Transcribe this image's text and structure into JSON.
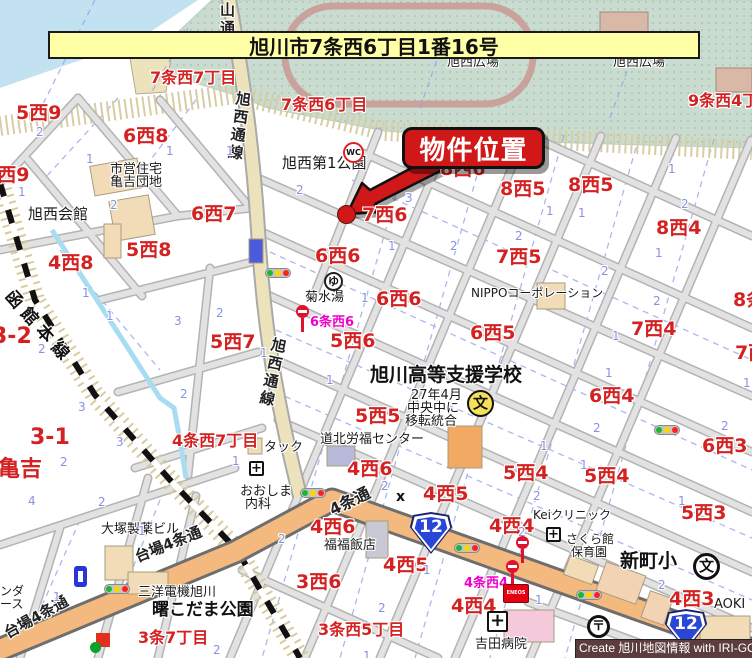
{
  "title_banner": {
    "text": "旭川市7条西6丁目1番16号"
  },
  "callout": {
    "label": "物件位置"
  },
  "credit": {
    "text": "Create 旭川地図情報 with IRI-GO"
  },
  "colors": {
    "banner_bg": "#ffffa6",
    "callout_bg": "#d01818",
    "park": "#cadcd0",
    "water": "#c2e2f2",
    "main_road": "#f4b97e",
    "sub_road": "#ece3bd",
    "block_label_red": "#d42222",
    "lot_number_blue": "#8892e0",
    "bus_label_magenta": "#f000c8",
    "route_shield_blue": "#2a46d4",
    "credit_bg": "#5c3d3d"
  },
  "map_labels": [
    {
      "n": "road-label-yamadori",
      "t": "山通",
      "x": 219,
      "y": 2,
      "c": "road vert"
    },
    {
      "n": "road-label-kyokusei-dori-upper",
      "t": "旭西通線",
      "x": 236,
      "y": 90,
      "c": "road vert",
      "r": 8
    },
    {
      "n": "road-label-kyokusei-dori-lower",
      "t": "旭西通線",
      "x": 272,
      "y": 336,
      "c": "road vert",
      "r": 12
    },
    {
      "n": "railway-label-hakodate-line",
      "t": "函館本線",
      "x": 14,
      "y": 288,
      "c": "rwy",
      "r": 48
    },
    {
      "n": "road-label-daiba-4jo-1",
      "t": "台場4条通",
      "x": 133,
      "y": 551,
      "c": "road-h",
      "r": -22
    },
    {
      "n": "road-label-daiba-4jo-2",
      "t": "台場4条通",
      "x": 2,
      "y": 628,
      "c": "road-h",
      "r": -29
    },
    {
      "n": "road-label-4jo-dori",
      "t": "4条通",
      "x": 327,
      "y": 504,
      "c": "road-h lg",
      "r": -26
    },
    {
      "n": "park-label-hiroba-1",
      "t": "旭西広場",
      "x": 447,
      "y": 56,
      "c": "poi"
    },
    {
      "n": "park-label-hiroba-2",
      "t": "旭西広場",
      "x": 613,
      "y": 56,
      "c": "poi"
    },
    {
      "n": "block-label",
      "t": "7条西7丁目",
      "x": 150,
      "y": 70,
      "c": "blk-md"
    },
    {
      "n": "block-label",
      "t": "7条西6丁目",
      "x": 281,
      "y": 97,
      "c": "blk-md"
    },
    {
      "n": "block-label",
      "t": "9条西4丁目",
      "x": 688,
      "y": 93,
      "c": "blk-md"
    },
    {
      "n": "block-label",
      "t": "5西9",
      "x": 16,
      "y": 104,
      "c": "blk"
    },
    {
      "n": "block-label",
      "t": "5西9",
      "x": -16,
      "y": 166,
      "c": "blk"
    },
    {
      "n": "block-label",
      "t": "6西8",
      "x": 123,
      "y": 127,
      "c": "blk"
    },
    {
      "n": "block-label",
      "t": "6西7",
      "x": 191,
      "y": 205,
      "c": "blk"
    },
    {
      "n": "block-label",
      "t": "5西8",
      "x": 126,
      "y": 241,
      "c": "blk"
    },
    {
      "n": "block-label",
      "t": "4西8",
      "x": 48,
      "y": 254,
      "c": "blk"
    },
    {
      "n": "poi-label-shiei-jutaku",
      "t": "市営住宅",
      "x": 110,
      "y": 163,
      "c": "poi"
    },
    {
      "n": "poi-label-kamekichi-danchi",
      "t": "亀吉団地",
      "x": 110,
      "y": 176,
      "c": "poi"
    },
    {
      "n": "poi-label-kyokusei-kaikan",
      "t": "旭西会館",
      "x": 28,
      "y": 207,
      "c": "poi-md"
    },
    {
      "n": "poi-label-kyokusei-park",
      "t": "旭西第1公園",
      "x": 282,
      "y": 156,
      "c": "poi-md"
    },
    {
      "n": "block-label",
      "t": "8西6",
      "x": 440,
      "y": 160,
      "c": "blk"
    },
    {
      "n": "block-label",
      "t": "8西5",
      "x": 500,
      "y": 180,
      "c": "blk"
    },
    {
      "n": "block-label",
      "t": "8西5",
      "x": 568,
      "y": 176,
      "c": "blk"
    },
    {
      "n": "block-label",
      "t": "8西4",
      "x": 656,
      "y": 219,
      "c": "blk"
    },
    {
      "n": "block-label",
      "t": "7西6",
      "x": 362,
      "y": 206,
      "c": "blk"
    },
    {
      "n": "block-label",
      "t": "7西5",
      "x": 496,
      "y": 248,
      "c": "blk"
    },
    {
      "n": "block-label",
      "t": "7西4",
      "x": 631,
      "y": 320,
      "c": "blk"
    },
    {
      "n": "block-label",
      "t": "8条西",
      "x": 733,
      "y": 291,
      "c": "blk"
    },
    {
      "n": "block-label",
      "t": "7西3",
      "x": 735,
      "y": 344,
      "c": "blk"
    },
    {
      "n": "block-label",
      "t": "6西6",
      "x": 315,
      "y": 247,
      "c": "blk"
    },
    {
      "n": "block-label",
      "t": "6西6",
      "x": 376,
      "y": 290,
      "c": "blk"
    },
    {
      "n": "block-label",
      "t": "6西5",
      "x": 470,
      "y": 324,
      "c": "blk"
    },
    {
      "n": "block-label",
      "t": "6西4",
      "x": 589,
      "y": 387,
      "c": "blk"
    },
    {
      "n": "block-label",
      "t": "6西3",
      "x": 702,
      "y": 437,
      "c": "blk"
    },
    {
      "n": "poi-label-kikusui-yu",
      "t": "菊水湯",
      "x": 305,
      "y": 291,
      "c": "poi"
    },
    {
      "n": "poi-label-nippo",
      "t": "NIPPOコーポレーション",
      "x": 471,
      "y": 287,
      "c": "poi-sm"
    },
    {
      "n": "block-label",
      "t": "5西6",
      "x": 330,
      "y": 332,
      "c": "blk"
    },
    {
      "n": "block-label",
      "t": "5西7",
      "x": 210,
      "y": 333,
      "c": "blk"
    },
    {
      "n": "block-label",
      "t": "3-2",
      "x": -8,
      "y": 326,
      "c": "blk-lg"
    },
    {
      "n": "block-label",
      "t": "3-1",
      "x": 30,
      "y": 427,
      "c": "blk-lg"
    },
    {
      "n": "poi-label-shien-school",
      "t": "旭川高等支援学校",
      "x": 370,
      "y": 366,
      "c": "poi-lg"
    },
    {
      "n": "poi-label-school-note-1",
      "t": "27年4月",
      "x": 411,
      "y": 389,
      "c": "poi"
    },
    {
      "n": "poi-label-school-note-2",
      "t": "中央中に",
      "x": 407,
      "y": 402,
      "c": "poi"
    },
    {
      "n": "poi-label-school-note-3",
      "t": "移転統合",
      "x": 405,
      "y": 415,
      "c": "poi"
    },
    {
      "n": "block-label",
      "t": "5西5",
      "x": 355,
      "y": 407,
      "c": "blk"
    },
    {
      "n": "block-label",
      "t": "4条西7丁目",
      "x": 172,
      "y": 433,
      "c": "blk-md"
    },
    {
      "n": "poi-label-tack",
      "t": "タック",
      "x": 264,
      "y": 441,
      "c": "poi"
    },
    {
      "n": "poi-label-rofuku-center",
      "t": "道北労福センター",
      "x": 320,
      "y": 433,
      "c": "poi"
    },
    {
      "n": "block-label",
      "t": "亀吉",
      "x": -2,
      "y": 459,
      "c": "blk-lg"
    },
    {
      "n": "block-label",
      "t": "4西6",
      "x": 347,
      "y": 460,
      "c": "blk"
    },
    {
      "n": "block-label",
      "t": "5西4",
      "x": 503,
      "y": 464,
      "c": "blk"
    },
    {
      "n": "block-label",
      "t": "5西4",
      "x": 584,
      "y": 467,
      "c": "blk"
    },
    {
      "n": "poi-label-oshima-1",
      "t": "おおしま",
      "x": 240,
      "y": 485,
      "c": "poi"
    },
    {
      "n": "poi-label-oshima-2",
      "t": "内科",
      "x": 245,
      "y": 498,
      "c": "poi"
    },
    {
      "n": "block-label",
      "t": "4西5",
      "x": 423,
      "y": 485,
      "c": "blk"
    },
    {
      "n": "crossing-mark",
      "t": "x",
      "x": 396,
      "y": 490,
      "c": "xmark"
    },
    {
      "n": "block-label",
      "t": "5西3",
      "x": 681,
      "y": 504,
      "c": "blk"
    },
    {
      "n": "poi-label-kei-clinic",
      "t": "Keiクリニック",
      "x": 533,
      "y": 509,
      "c": "poi-sm"
    },
    {
      "n": "block-label",
      "t": "4西4",
      "x": 489,
      "y": 517,
      "c": "blk"
    },
    {
      "n": "block-label",
      "t": "4西6",
      "x": 310,
      "y": 518,
      "c": "blk"
    },
    {
      "n": "poi-label-otsuka",
      "t": "大塚製薬ビル",
      "x": 101,
      "y": 523,
      "c": "poi"
    },
    {
      "n": "poi-label-fukufuku",
      "t": "福福飯店",
      "x": 324,
      "y": 539,
      "c": "poi"
    },
    {
      "n": "poi-label-sakura-1",
      "t": "さくら館",
      "x": 566,
      "y": 533,
      "c": "poi-sm"
    },
    {
      "n": "poi-label-sakura-2",
      "t": "保育園",
      "x": 571,
      "y": 546,
      "c": "poi-sm"
    },
    {
      "n": "poi-label-shinmachi-elementary",
      "t": "新町小",
      "x": 620,
      "y": 552,
      "c": "poi-lg"
    },
    {
      "n": "block-label",
      "t": "4西5",
      "x": 383,
      "y": 556,
      "c": "blk"
    },
    {
      "n": "block-label",
      "t": "3西6",
      "x": 296,
      "y": 573,
      "c": "blk"
    },
    {
      "n": "busstop-label",
      "t": "4条西4",
      "x": 464,
      "y": 577,
      "c": "mag"
    },
    {
      "n": "busstop-label",
      "t": "6条西6",
      "x": 310,
      "y": 316,
      "c": "mag"
    },
    {
      "n": "poi-label-sanyo",
      "t": "三洋電機旭川",
      "x": 138,
      "y": 586,
      "c": "poi"
    },
    {
      "n": "poi-label-akebono-park",
      "t": "曙こだま公園",
      "x": 152,
      "y": 602,
      "c": "poi-lg2"
    },
    {
      "n": "poi-label-edge-1",
      "t": "ンダ",
      "x": 0,
      "y": 585,
      "c": "poi-sm"
    },
    {
      "n": "poi-label-edge-2",
      "t": "ース",
      "x": 0,
      "y": 598,
      "c": "poi-sm"
    },
    {
      "n": "block-label",
      "t": "4西4",
      "x": 451,
      "y": 597,
      "c": "blk"
    },
    {
      "n": "block-label",
      "t": "4西3",
      "x": 669,
      "y": 590,
      "c": "blk"
    },
    {
      "n": "poi-label-aoki",
      "t": "AOKI",
      "x": 714,
      "y": 598,
      "c": "poi"
    },
    {
      "n": "block-label",
      "t": "3条7丁目",
      "x": 138,
      "y": 630,
      "c": "blk-md"
    },
    {
      "n": "block-label",
      "t": "3条西5丁目",
      "x": 318,
      "y": 622,
      "c": "blk-md"
    },
    {
      "n": "poi-label-yoshida-hospital",
      "t": "吉田病院",
      "x": 475,
      "y": 638,
      "c": "poi"
    },
    {
      "n": "lot-number",
      "t": "2",
      "x": 36,
      "y": 126,
      "c": "num"
    },
    {
      "n": "lot-number",
      "t": "1",
      "x": 86,
      "y": 153,
      "c": "num"
    },
    {
      "n": "lot-number",
      "t": "1",
      "x": 166,
      "y": 145,
      "c": "num"
    },
    {
      "n": "lot-number",
      "t": "1",
      "x": 226,
      "y": 145,
      "c": "num"
    },
    {
      "n": "lot-number",
      "t": "1",
      "x": 18,
      "y": 186,
      "c": "num"
    },
    {
      "n": "lot-number",
      "t": "2",
      "x": 110,
      "y": 199,
      "c": "num"
    },
    {
      "n": "lot-number",
      "t": "1",
      "x": 82,
      "y": 287,
      "c": "num"
    },
    {
      "n": "lot-number",
      "t": "1",
      "x": 106,
      "y": 310,
      "c": "num"
    },
    {
      "n": "lot-number",
      "t": "3",
      "x": 174,
      "y": 315,
      "c": "num"
    },
    {
      "n": "lot-number",
      "t": "2",
      "x": 216,
      "y": 307,
      "c": "num"
    },
    {
      "n": "lot-number",
      "t": "2",
      "x": 38,
      "y": 343,
      "c": "num"
    },
    {
      "n": "lot-number",
      "t": "2",
      "x": 180,
      "y": 388,
      "c": "num"
    },
    {
      "n": "lot-number",
      "t": "3",
      "x": 78,
      "y": 401,
      "c": "num"
    },
    {
      "n": "lot-number",
      "t": "3",
      "x": 116,
      "y": 436,
      "c": "num"
    },
    {
      "n": "lot-number",
      "t": "2",
      "x": 60,
      "y": 456,
      "c": "num"
    },
    {
      "n": "lot-number",
      "t": "1",
      "x": 232,
      "y": 455,
      "c": "num"
    },
    {
      "n": "lot-number",
      "t": "2",
      "x": 296,
      "y": 184,
      "c": "num"
    },
    {
      "n": "lot-number",
      "t": "3",
      "x": 405,
      "y": 192,
      "c": "num"
    },
    {
      "n": "lot-number",
      "t": "2",
      "x": 450,
      "y": 240,
      "c": "num"
    },
    {
      "n": "lot-number",
      "t": "1",
      "x": 388,
      "y": 240,
      "c": "num"
    },
    {
      "n": "lot-number",
      "t": "2",
      "x": 538,
      "y": 155,
      "c": "num"
    },
    {
      "n": "lot-number",
      "t": "1",
      "x": 668,
      "y": 163,
      "c": "num"
    },
    {
      "n": "lot-number",
      "t": "2",
      "x": 515,
      "y": 230,
      "c": "num"
    },
    {
      "n": "lot-number",
      "t": "2",
      "x": 681,
      "y": 198,
      "c": "num"
    },
    {
      "n": "lot-number",
      "t": "1",
      "x": 655,
      "y": 247,
      "c": "num"
    },
    {
      "n": "lot-number",
      "t": "2",
      "x": 601,
      "y": 265,
      "c": "num"
    },
    {
      "n": "lot-number",
      "t": "1",
      "x": 546,
      "y": 205,
      "c": "num"
    },
    {
      "n": "lot-number",
      "t": "1",
      "x": 578,
      "y": 207,
      "c": "num"
    },
    {
      "n": "lot-number",
      "t": "2",
      "x": 653,
      "y": 295,
      "c": "num"
    },
    {
      "n": "lot-number",
      "t": "1",
      "x": 612,
      "y": 330,
      "c": "num"
    },
    {
      "n": "lot-number",
      "t": "1",
      "x": 605,
      "y": 367,
      "c": "num"
    },
    {
      "n": "lot-number",
      "t": "2",
      "x": 593,
      "y": 422,
      "c": "num"
    },
    {
      "n": "lot-number",
      "t": "2",
      "x": 721,
      "y": 420,
      "c": "num"
    },
    {
      "n": "lot-number",
      "t": "1",
      "x": 540,
      "y": 440,
      "c": "num"
    },
    {
      "n": "lot-number",
      "t": "1",
      "x": 580,
      "y": 459,
      "c": "num"
    },
    {
      "n": "lot-number",
      "t": "1",
      "x": 743,
      "y": 377,
      "c": "num"
    },
    {
      "n": "lot-number",
      "t": "1",
      "x": 361,
      "y": 292,
      "c": "num"
    },
    {
      "n": "lot-number",
      "t": "1",
      "x": 260,
      "y": 347,
      "c": "num"
    },
    {
      "n": "lot-number",
      "t": "1",
      "x": 326,
      "y": 374,
      "c": "num"
    },
    {
      "n": "lot-number",
      "t": "4",
      "x": 28,
      "y": 495,
      "c": "num"
    },
    {
      "n": "lot-number",
      "t": "2",
      "x": 98,
      "y": 496,
      "c": "num"
    },
    {
      "n": "lot-number",
      "t": "1",
      "x": 138,
      "y": 525,
      "c": "num"
    },
    {
      "n": "lot-number",
      "t": "1",
      "x": 53,
      "y": 591,
      "c": "num"
    },
    {
      "n": "lot-number",
      "t": "2",
      "x": 213,
      "y": 644,
      "c": "num"
    },
    {
      "n": "lot-number",
      "t": "2",
      "x": 278,
      "y": 533,
      "c": "num"
    },
    {
      "n": "lot-number",
      "t": "1",
      "x": 423,
      "y": 564,
      "c": "num"
    },
    {
      "n": "lot-number",
      "t": "2",
      "x": 378,
      "y": 602,
      "c": "num"
    },
    {
      "n": "lot-number",
      "t": "1",
      "x": 363,
      "y": 650,
      "c": "num"
    },
    {
      "n": "lot-number",
      "t": "2",
      "x": 381,
      "y": 480,
      "c": "num"
    },
    {
      "n": "lot-number",
      "t": "2",
      "x": 533,
      "y": 490,
      "c": "num"
    },
    {
      "n": "lot-number",
      "t": "1",
      "x": 678,
      "y": 495,
      "c": "num"
    },
    {
      "n": "lot-number",
      "t": "2",
      "x": 518,
      "y": 526,
      "c": "num"
    },
    {
      "n": "lot-number",
      "t": "2",
      "x": 658,
      "y": 579,
      "c": "num"
    },
    {
      "n": "lot-number",
      "t": "1",
      "x": 535,
      "y": 594,
      "c": "num"
    },
    {
      "n": "lot-number",
      "t": "1",
      "x": 676,
      "y": 650,
      "c": "num"
    }
  ],
  "icons": [
    {
      "n": "traffic-light-icon",
      "type": "light",
      "x": 265,
      "y": 268
    },
    {
      "n": "traffic-light-icon",
      "type": "light",
      "x": 104,
      "y": 584
    },
    {
      "n": "traffic-light-icon",
      "type": "light",
      "x": 300,
      "y": 488
    },
    {
      "n": "traffic-light-icon",
      "type": "light",
      "x": 454,
      "y": 543
    },
    {
      "n": "traffic-light-icon",
      "type": "light",
      "x": 576,
      "y": 590
    },
    {
      "n": "traffic-light-icon",
      "type": "light",
      "x": 654,
      "y": 425
    },
    {
      "n": "bus-stop-icon",
      "type": "bus",
      "x": 296,
      "y": 305
    },
    {
      "n": "bus-stop-icon",
      "type": "bus",
      "x": 516,
      "y": 536
    },
    {
      "n": "bus-stop-icon",
      "type": "bus",
      "x": 506,
      "y": 560
    },
    {
      "n": "toilet-icon",
      "type": "wc",
      "x": 343,
      "y": 142,
      "t": "WC"
    },
    {
      "n": "bathhouse-icon",
      "type": "yu",
      "x": 324,
      "y": 272,
      "t": "ゆ"
    },
    {
      "n": "school-icon-yellow",
      "type": "school-y",
      "x": 467,
      "y": 390,
      "t": "文"
    },
    {
      "n": "school-icon",
      "type": "school",
      "x": 693,
      "y": 553,
      "t": "文"
    },
    {
      "n": "post-office-icon",
      "type": "post",
      "x": 587,
      "y": 615,
      "t": "〒"
    },
    {
      "n": "hospital-icon",
      "type": "cross",
      "x": 249,
      "y": 461,
      "t": "+"
    },
    {
      "n": "hospital-icon",
      "type": "cross",
      "x": 546,
      "y": 527,
      "t": "+"
    },
    {
      "n": "hospital-icon",
      "type": "cross cross-lg",
      "x": 487,
      "y": 611,
      "t": "+"
    },
    {
      "n": "route-12-shield",
      "type": "shield",
      "x": 409,
      "y": 512,
      "t": "12"
    },
    {
      "n": "route-12-shield",
      "type": "shield",
      "x": 664,
      "y": 609,
      "t": "12"
    },
    {
      "n": "gas-station-sign",
      "type": "eneos",
      "x": 503,
      "y": 584,
      "t": "ENEOS"
    },
    {
      "n": "building-icon-blue",
      "type": "bluebldg",
      "x": 74,
      "y": 566
    },
    {
      "n": "shop-icon-red",
      "type": "redsq",
      "x": 96,
      "y": 612
    },
    {
      "n": "property-location-dot",
      "type": "dot",
      "x": 337,
      "y": 205
    }
  ]
}
